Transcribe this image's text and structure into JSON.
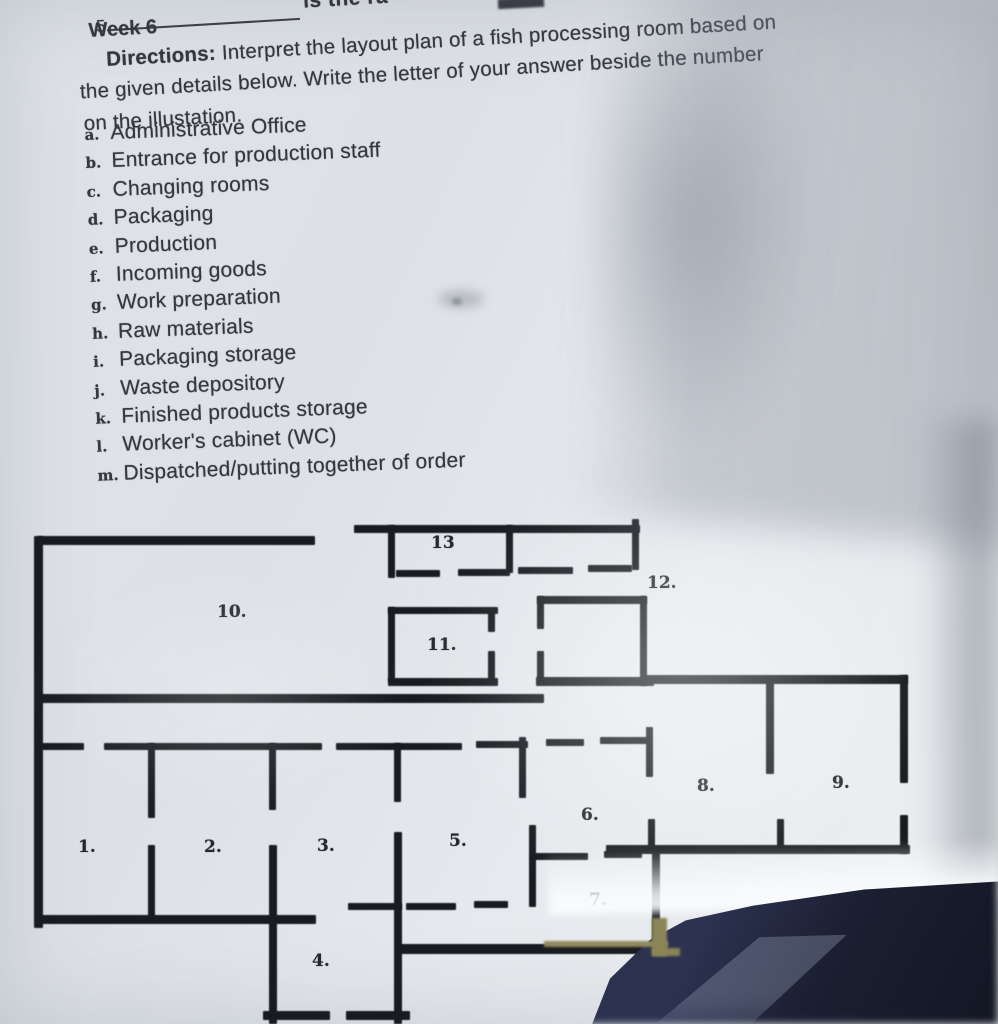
{
  "colors": {
    "paper": "#e6eaee",
    "ink": "#34373e",
    "wall": "#191b20",
    "table_shadow": "#1b1f31",
    "olive_edge": "#8a8557"
  },
  "header": {
    "question_number": "5.",
    "question_fragment": "is the ra",
    "week": "Week 6",
    "directions_label": "Directions:",
    "directions_text": " Interpret the layout plan of a fish processing room based on",
    "directions_line2": "the given details below. Write the letter of your answer beside the number",
    "directions_line3": "on the illustation."
  },
  "legend": {
    "items": [
      {
        "letter": "a.",
        "text": "Administrative Office"
      },
      {
        "letter": "b.",
        "text": "Entrance for production staff"
      },
      {
        "letter": "c.",
        "text": "Changing rooms"
      },
      {
        "letter": "d.",
        "text": "Packaging"
      },
      {
        "letter": "e.",
        "text": "Production"
      },
      {
        "letter": "f.",
        "text": "Incoming goods"
      },
      {
        "letter": "g.",
        "text": "Work preparation"
      },
      {
        "letter": "h.",
        "text": "Raw materials"
      },
      {
        "letter": "i.",
        "text": "Packaging storage"
      },
      {
        "letter": "j.",
        "text": "Waste depository"
      },
      {
        "letter": "k.",
        "text": "Finished products storage"
      },
      {
        "letter": "l.",
        "text": "Worker's cabinet (WC)"
      },
      {
        "letter": "m.",
        "text": "Dispatched/putting together of order"
      }
    ]
  },
  "plan": {
    "rooms": [
      {
        "number": "1."
      },
      {
        "number": "2."
      },
      {
        "number": "3."
      },
      {
        "number": "4."
      },
      {
        "number": "5."
      },
      {
        "number": "6."
      },
      {
        "number": "7."
      },
      {
        "number": "8."
      },
      {
        "number": "9."
      },
      {
        "number": "10."
      },
      {
        "number": "11."
      },
      {
        "number": "12."
      },
      {
        "number": "13"
      }
    ]
  }
}
